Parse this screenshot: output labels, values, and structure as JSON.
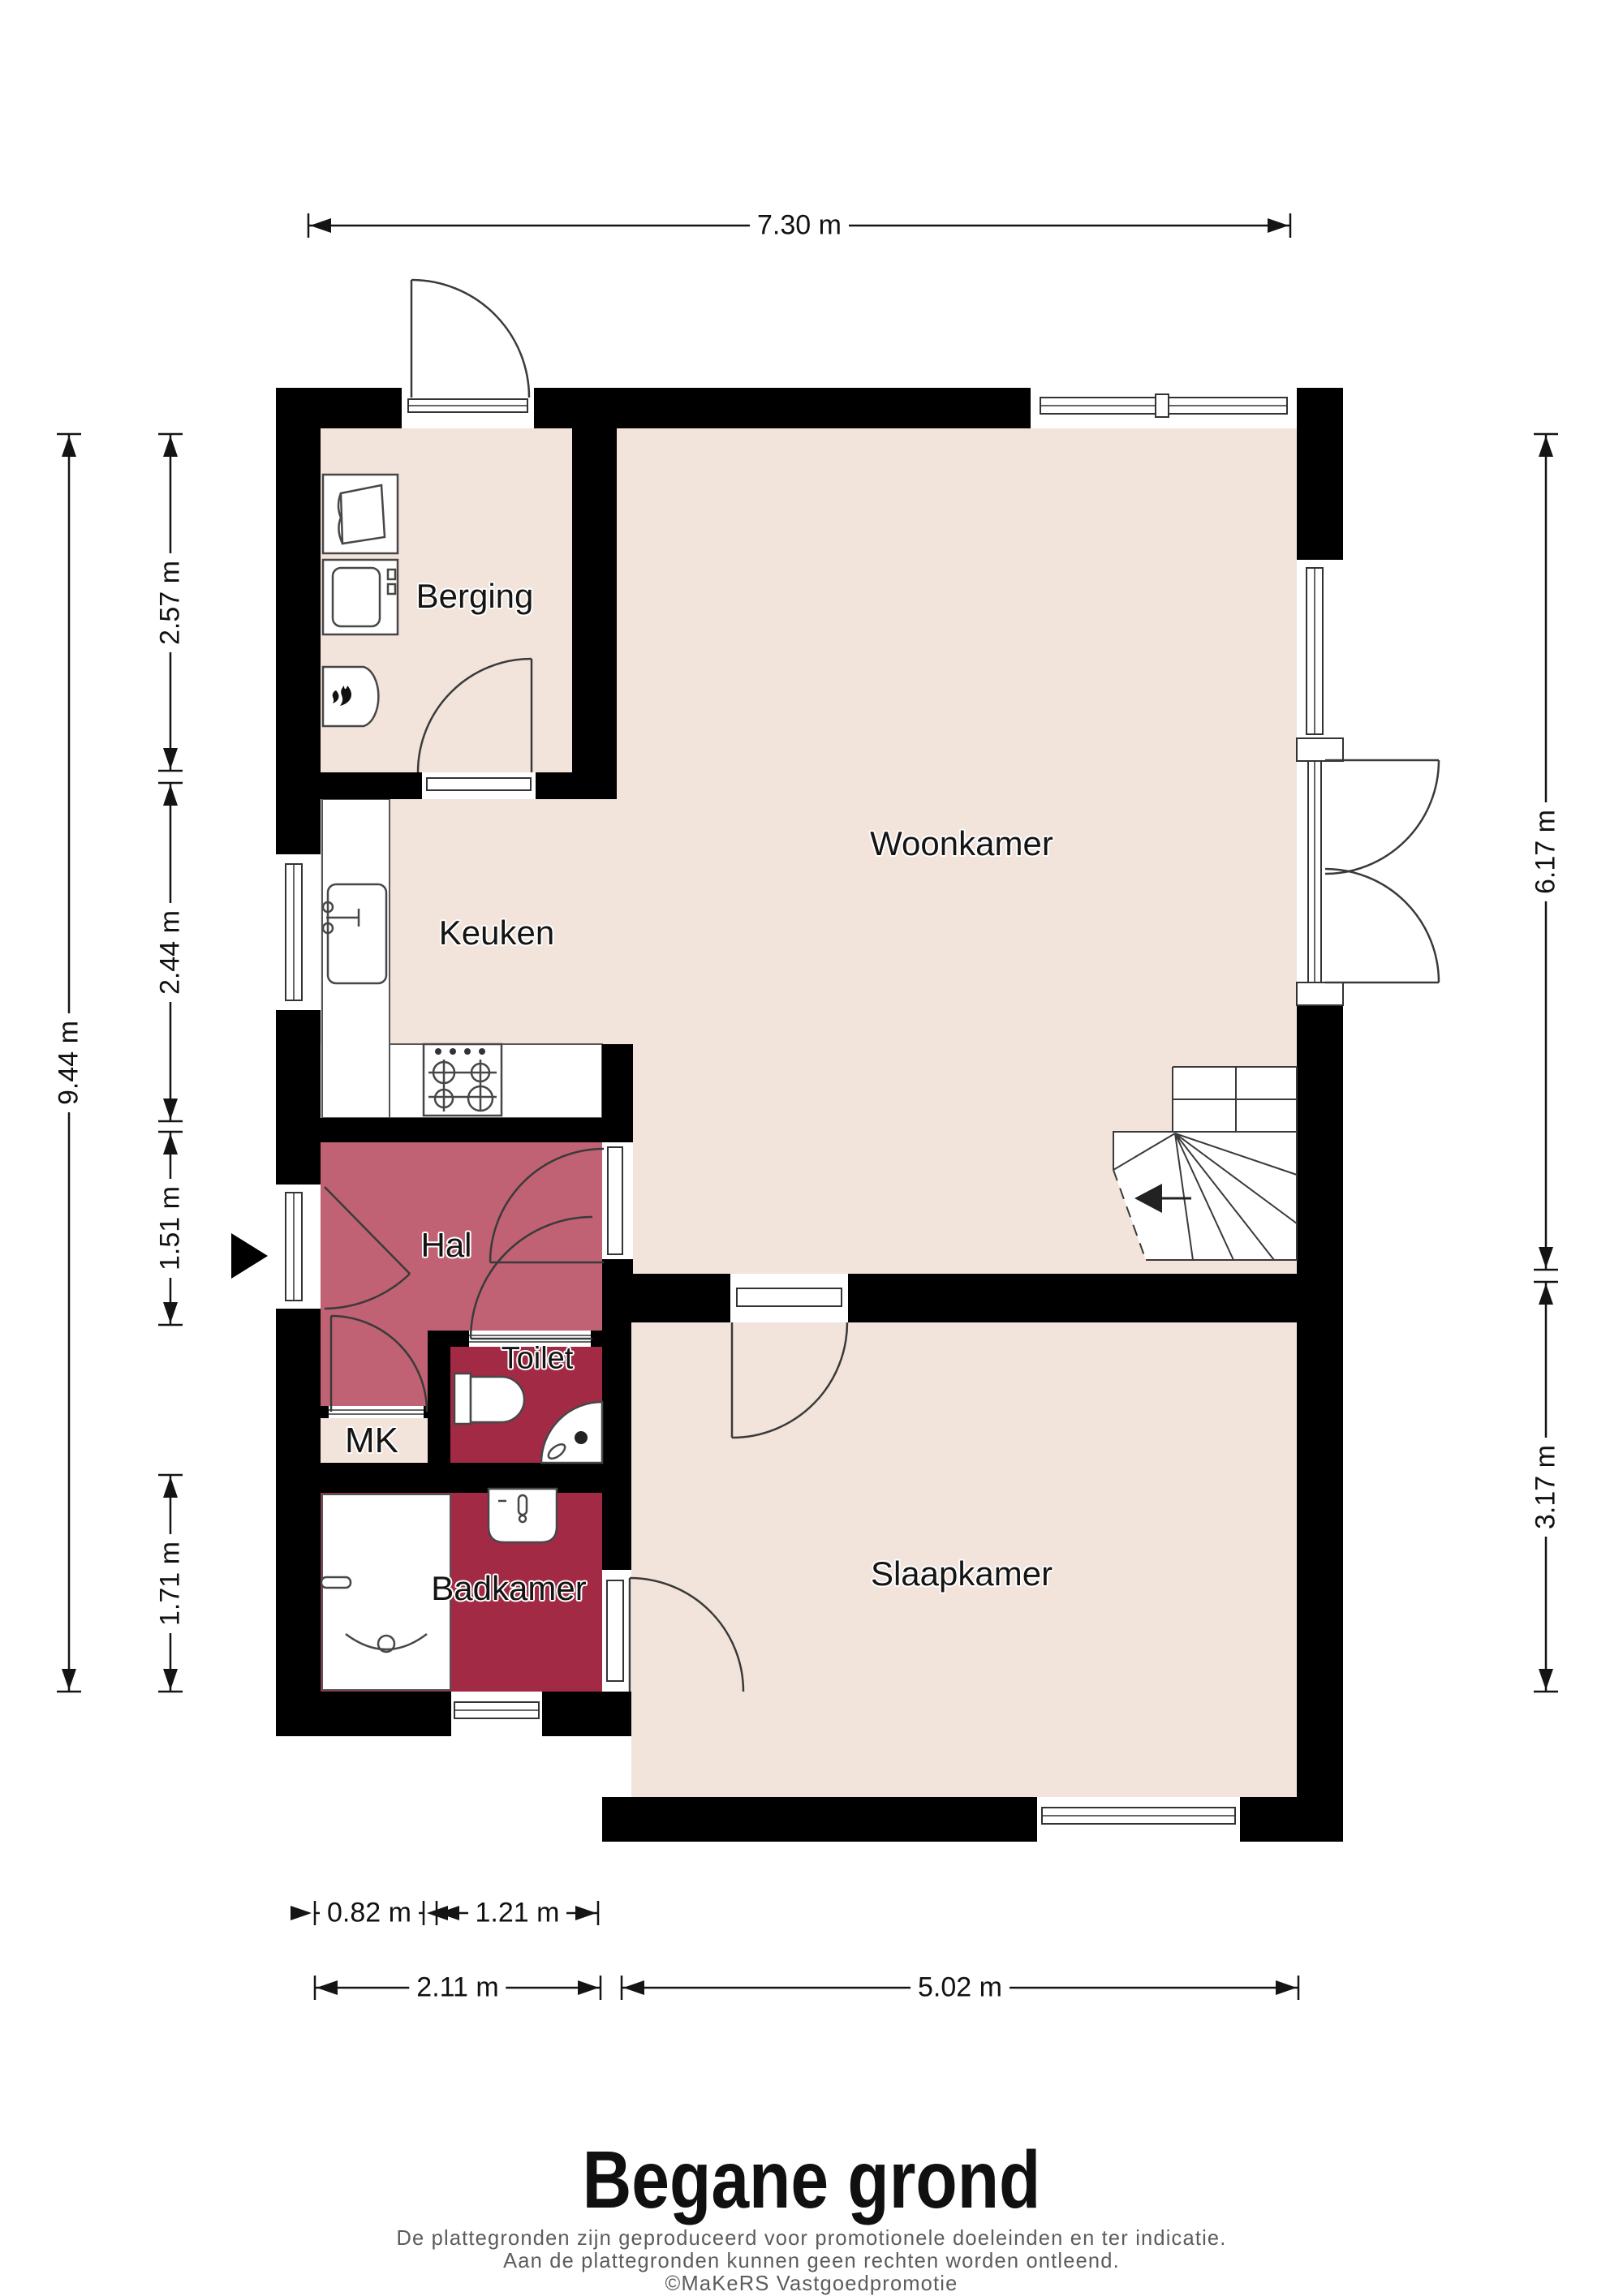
{
  "title": "Begane grond",
  "footer": {
    "line1": "De plattegronden zijn geproduceerd voor promotionele doeleinden en ter indicatie.",
    "line2": "Aan de plattegronden kunnen geen rechten worden ontleend.",
    "line3": "©MaKeRS Vastgoedpromotie"
  },
  "rooms": {
    "berging": {
      "label": "Berging"
    },
    "keuken": {
      "label": "Keuken"
    },
    "woonkamer": {
      "label": "Woonkamer"
    },
    "hal": {
      "label": "Hal"
    },
    "toilet": {
      "label": "Toilet"
    },
    "mk": {
      "label": "MK"
    },
    "badkamer": {
      "label": "Badkamer"
    },
    "slaapkamer": {
      "label": "Slaapkamer"
    }
  },
  "dims": {
    "width_total": {
      "label": "7.30 m"
    },
    "height_total": {
      "label": "9.44 m"
    },
    "left_berging": {
      "label": "2.57 m"
    },
    "left_keuken": {
      "label": "2.44 m"
    },
    "left_hal": {
      "label": "1.51 m"
    },
    "left_badkamer": {
      "label": "1.71 m"
    },
    "right_woonkamer": {
      "label": "6.17 m"
    },
    "right_slaapkamer": {
      "label": "3.17 m"
    },
    "bottom_mk": {
      "label": "0.82 m"
    },
    "bottom_toilet": {
      "label": "1.21 m"
    },
    "bottom_left": {
      "label": "2.11 m"
    },
    "bottom_slaapkamer": {
      "label": "5.02 m"
    }
  },
  "colors": {
    "floor": "#f2e4db",
    "hal": "#c06274",
    "wet_room": "#a32a44",
    "wall": "#000000",
    "dimension": "#141414",
    "footer_text": "#5c5c5c"
  },
  "icons": [
    "entrance-arrow-icon",
    "stairs-icon",
    "washing-machine-icon",
    "laundry-basket-icon",
    "boiler-icon",
    "flame-icon",
    "kitchen-sink-icon",
    "faucet-icon",
    "stove-icon",
    "toilet-icon",
    "corner-basin-icon",
    "washbasin-icon",
    "shower-drain-icon",
    "door-arc-icon",
    "window-icon"
  ]
}
